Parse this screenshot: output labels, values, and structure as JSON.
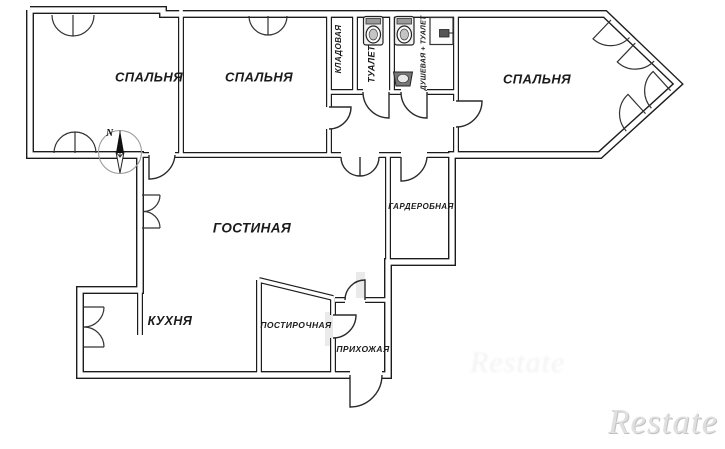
{
  "page": {
    "type": "apartment-floor-plan"
  },
  "plan": {
    "rooms": [
      {
        "id": "bedroom-1",
        "label": "СПАЛЬНЯ"
      },
      {
        "id": "bedroom-2",
        "label": "СПАЛЬНЯ"
      },
      {
        "id": "bedroom-3",
        "label": "СПАЛЬНЯ"
      },
      {
        "id": "storage",
        "label": "КЛАДОВАЯ"
      },
      {
        "id": "toilet",
        "label": "ТУАЛЕТ"
      },
      {
        "id": "shower-toilet",
        "label": "ДУШЕВАЯ + ТУАЛЕТ"
      },
      {
        "id": "living-room",
        "label": "ГОСТИНАЯ"
      },
      {
        "id": "wardrobe",
        "label": "ГАРДЕРОБНАЯ"
      },
      {
        "id": "kitchen",
        "label": "КУХНЯ"
      },
      {
        "id": "laundry",
        "label": "ПОСТИРОЧНАЯ"
      },
      {
        "id": "hallway",
        "label": "ПРИХОЖАЯ"
      }
    ],
    "compass": {
      "label": "N"
    },
    "watermark": {
      "text": "Restate"
    },
    "fixtures": [
      {
        "name": "toilet"
      },
      {
        "name": "toilet"
      },
      {
        "name": "sink"
      },
      {
        "name": "shower"
      }
    ],
    "colors": {
      "line": "#1c1c1c",
      "background": "#ffffff",
      "watermark": "#e0e0e0"
    }
  }
}
